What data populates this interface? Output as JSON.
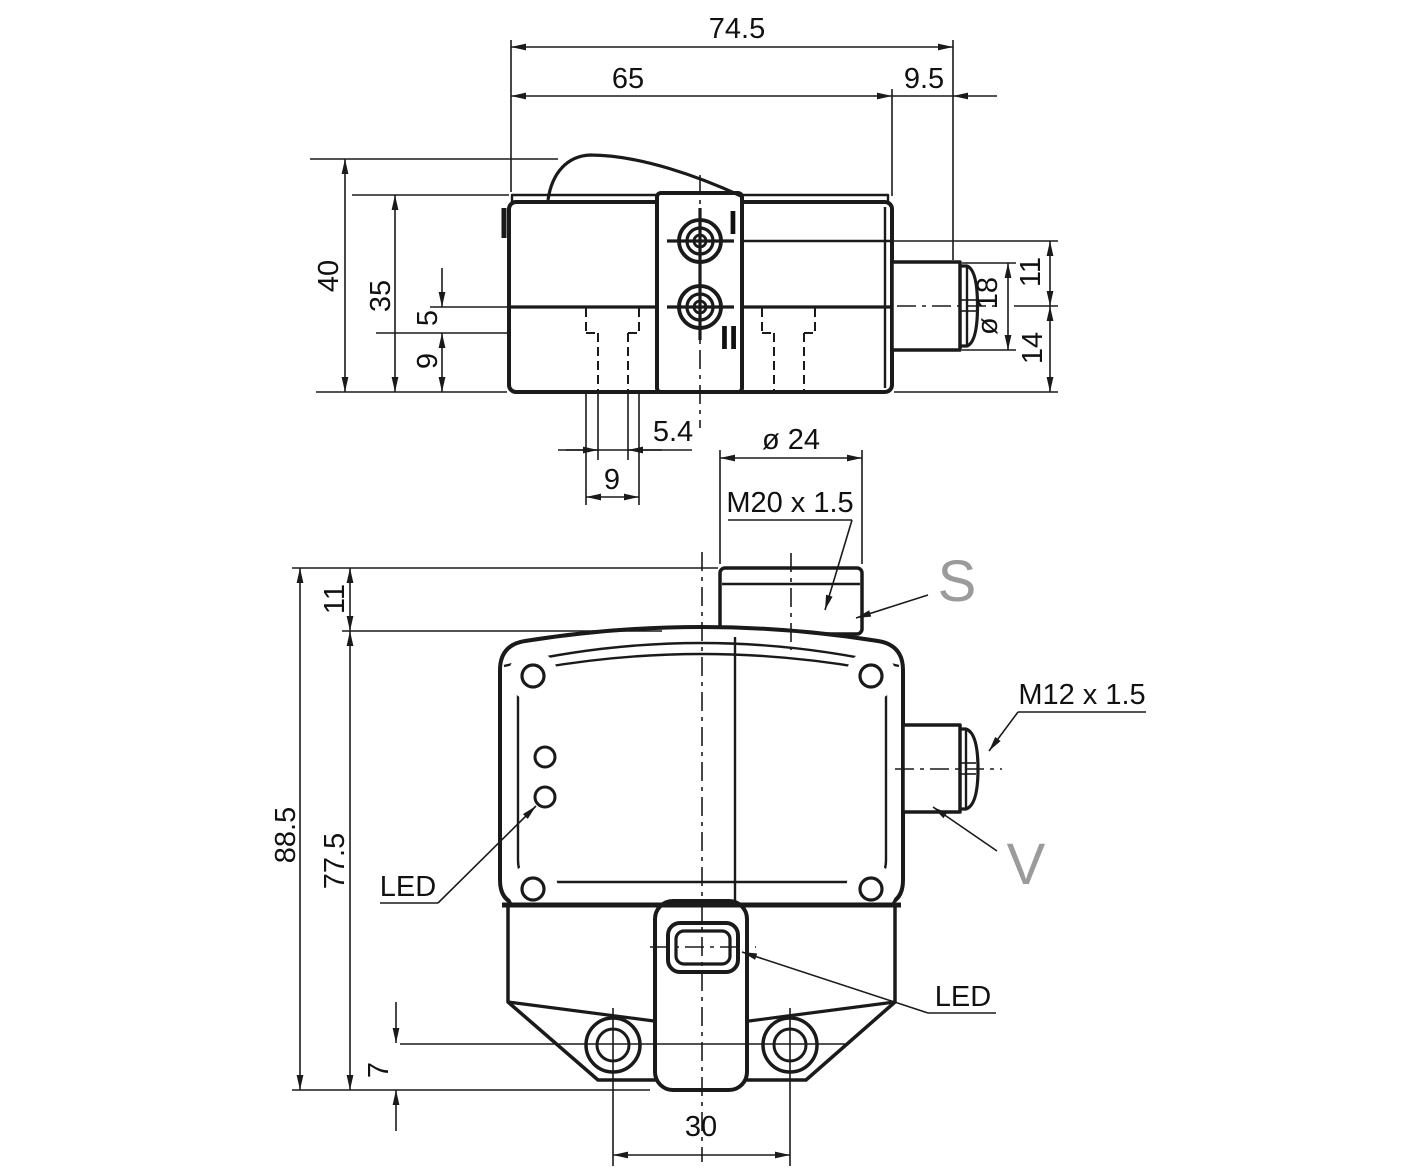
{
  "drawing": {
    "type": "technical-dimension-drawing",
    "colors": {
      "line": "#1a1a1a",
      "label_gray": "#9b9b9b",
      "background": "#ffffff"
    },
    "side_view": {
      "dim_total_width": "74.5",
      "dim_body_width": "65",
      "dim_connector_length": "9.5",
      "dim_total_height": "40",
      "dim_body_height": "35",
      "dim_groove_offset": "5",
      "dim_groove_depth": "9",
      "dim_slot_narrow": "5.4",
      "dim_slot_wide": "9",
      "dim_connector_diameter": "ø 18",
      "dim_connector_above_axis": "11",
      "dim_connector_below_axis": "14",
      "label_mount_hole_1": "I",
      "label_mount_hole_2": "II"
    },
    "front_view": {
      "dim_gland_diameter": "ø 24",
      "label_gland_thread": "M20 x 1.5",
      "label_sensor_port": "S",
      "label_connector_thread": "M12 x 1.5",
      "label_valve_port": "V",
      "label_led_side": "LED",
      "label_led_front": "LED",
      "dim_total_height": "88.5",
      "dim_body_height": "77.5",
      "dim_gland_height": "11",
      "dim_foot_height": "7",
      "dim_hole_spacing": "30"
    }
  }
}
